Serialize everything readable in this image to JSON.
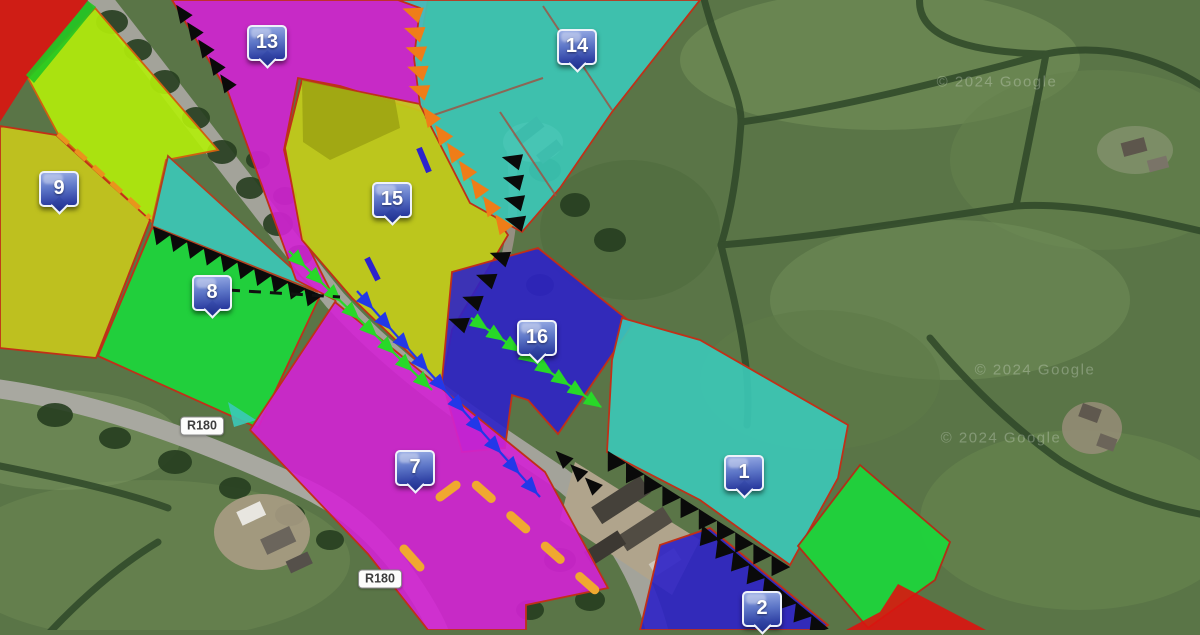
{
  "map": {
    "attribution": "© 2024 Google",
    "watermarks": [
      {
        "x": 997,
        "y": 82
      },
      {
        "x": 1035,
        "y": 370
      },
      {
        "x": 1001,
        "y": 438
      }
    ],
    "road_labels": [
      {
        "text": "R180",
        "x": 202,
        "y": 426
      },
      {
        "text": "R180",
        "x": 380,
        "y": 579
      }
    ],
    "markers": [
      {
        "label": "13",
        "x": 265,
        "y": 41
      },
      {
        "label": "14",
        "x": 575,
        "y": 45
      },
      {
        "label": "9",
        "x": 57,
        "y": 187
      },
      {
        "label": "15",
        "x": 390,
        "y": 198
      },
      {
        "label": "8",
        "x": 210,
        "y": 291
      },
      {
        "label": "16",
        "x": 535,
        "y": 336
      },
      {
        "label": "7",
        "x": 413,
        "y": 466
      },
      {
        "label": "1",
        "x": 742,
        "y": 471
      },
      {
        "label": "2",
        "x": 760,
        "y": 607
      }
    ],
    "parcels": [
      {
        "marker": "13",
        "color": "#d322d4"
      },
      {
        "marker": "14",
        "color": "#3bc9b8"
      },
      {
        "marker": "15",
        "color": "#c6cf18"
      },
      {
        "marker": "9",
        "color": "#c9c91b"
      },
      {
        "marker": "8",
        "color": "#1bd93b"
      },
      {
        "marker": "16",
        "color": "#2d22c6"
      },
      {
        "marker": "7",
        "color": "#d322d4"
      },
      {
        "marker": "1",
        "color": "#3bc9b8"
      },
      {
        "marker": "2",
        "color": "#2d22c6"
      },
      {
        "marker": "",
        "color": "#dc1410"
      },
      {
        "marker": "",
        "color": "#b2ee0a"
      },
      {
        "marker": "",
        "color": "#1bd93b"
      }
    ],
    "colors": {
      "magenta": "#d322d4",
      "cyan": "#3bc9b8",
      "blue": "#2d22c6",
      "bright_green": "#1bd93b",
      "yellow": "#c6cf18",
      "chartreuse": "#b2ee0a",
      "olive": "#c9c91b",
      "red": "#dc1410",
      "outline_red": "#c03018",
      "orange_chain": "#ef7d18",
      "green_chain": "#28d828",
      "blue_chain": "#2238e8",
      "black_chain": "#0a0a0a",
      "dash_orange": "#f0a830",
      "pin_blue": "#25359c"
    },
    "chains": [
      {
        "id": "orange-chain-upper",
        "kind": "arrow",
        "color": "#ef7d18",
        "apex": 200,
        "count": 5,
        "size": 11,
        "points": [
          [
            413,
            3
          ],
          [
            421,
            100
          ]
        ]
      },
      {
        "id": "orange-chain-lower",
        "kind": "arrow",
        "color": "#ef7d18",
        "apex": 235,
        "count": 7,
        "size": 11,
        "points": [
          [
            424,
            108
          ],
          [
            508,
            233
          ]
        ]
      },
      {
        "id": "black-chain-top-road",
        "kind": "arrow",
        "color": "#0a0a0a",
        "apex": 235,
        "count": 5,
        "size": 10,
        "points": [
          [
            177,
            5
          ],
          [
            232,
            92
          ]
        ]
      },
      {
        "id": "black-chain-driveway-1",
        "kind": "arrow",
        "color": "#0a0a0a",
        "apex": 195,
        "count": 4,
        "size": 11,
        "points": [
          [
            513,
            150
          ],
          [
            517,
            232
          ]
        ]
      },
      {
        "id": "black-chain-driveway-2",
        "kind": "arrow",
        "color": "#0a0a0a",
        "apex": 200,
        "count": 4,
        "size": 11,
        "points": [
          [
            508,
            246
          ],
          [
            453,
            334
          ]
        ]
      },
      {
        "id": "black-chain-mid-road",
        "kind": "arrow",
        "color": "#0a0a0a",
        "apex": 225,
        "count": 3,
        "size": 10,
        "points": [
          [
            556,
            452
          ],
          [
            600,
            492
          ]
        ]
      },
      {
        "id": "green-chain-road",
        "kind": "arrow",
        "color": "#28d828",
        "apex": 44,
        "count": 8,
        "size": 10,
        "line": "#28d828",
        "points": [
          [
            289,
            251
          ],
          [
            432,
            390
          ]
        ]
      },
      {
        "id": "blue-chain-road",
        "kind": "arrow",
        "color": "#2238e8",
        "apex": 48,
        "count": 10,
        "size": 10,
        "line": "#2238e8",
        "points": [
          [
            357,
            291
          ],
          [
            540,
            497
          ]
        ]
      },
      {
        "id": "green-chain-parcel16",
        "kind": "arrow",
        "color": "#28d828",
        "apex": 34,
        "count": 8,
        "size": 10,
        "line": "#28d828",
        "points": [
          [
            471,
            318
          ],
          [
            601,
            407
          ]
        ]
      },
      {
        "id": "sawtooth-green8-boundary",
        "kind": "tooth",
        "color": "#0a0a0a",
        "apex": 112,
        "count": 10,
        "size": 10,
        "points": [
          [
            154,
            227
          ],
          [
            322,
            295
          ]
        ]
      },
      {
        "id": "sawtooth-parcel1-boundary",
        "kind": "tooth",
        "color": "#0a0a0a",
        "apex": 122,
        "count": 10,
        "size": 11,
        "points": [
          [
            608,
            451
          ],
          [
            790,
            567
          ]
        ]
      },
      {
        "id": "sawtooth-parcel2-boundary",
        "kind": "tooth",
        "color": "#0a0a0a",
        "apex": 129,
        "count": 8,
        "size": 11,
        "points": [
          [
            703,
            526
          ],
          [
            828,
            628
          ]
        ]
      }
    ],
    "dashes": [
      {
        "id": "black-dashed-line",
        "color": "#111111",
        "width": 3,
        "dash": "12 9",
        "points": [
          [
            228,
            290
          ],
          [
            340,
            297
          ]
        ]
      },
      {
        "id": "orange-dashed-boundary",
        "color": "#e8951c",
        "width": 5,
        "dash": "14 10",
        "points": [
          [
            58,
            134
          ],
          [
            150,
            218
          ]
        ]
      },
      {
        "id": "orange-dash-path",
        "color": "#f0a830",
        "width": 9,
        "dash": "20 26",
        "cap": "round",
        "points": [
          [
            440,
            497
          ],
          [
            467,
            477
          ],
          [
            604,
            598
          ]
        ]
      },
      {
        "id": "orange-dash-single",
        "color": "#f0a830",
        "width": 9,
        "dash": "26 4",
        "cap": "round",
        "points": [
          [
            404,
            549
          ],
          [
            420,
            567
          ]
        ]
      },
      {
        "id": "blue-segment-upper",
        "color": "#2d22cc",
        "width": 6,
        "dash": "",
        "points": [
          [
            419,
            148
          ],
          [
            429,
            172
          ]
        ]
      },
      {
        "id": "blue-segment-lower",
        "color": "#2d22cc",
        "width": 6,
        "dash": "",
        "points": [
          [
            367,
            258
          ],
          [
            378,
            280
          ]
        ]
      }
    ]
  }
}
